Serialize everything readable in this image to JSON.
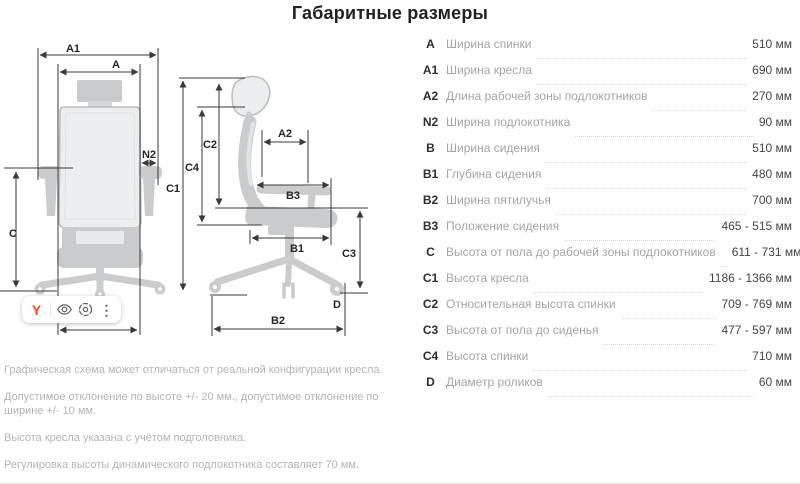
{
  "title": "Габаритные размеры",
  "diagram": {
    "labels": {
      "a": "A",
      "a1": "A1",
      "a2": "A2",
      "n2": "N2",
      "b1": "B1",
      "b2": "B2",
      "b3": "B3",
      "c": "C",
      "c1": "C1",
      "c2": "C2",
      "c3": "C3",
      "c4": "C4",
      "d": "D"
    }
  },
  "toolbar": {
    "yandex_label": "Y",
    "more_label": "⋮",
    "icons": [
      "yandex-logo",
      "eye-icon",
      "search-by-image-icon",
      "more-dots-icon"
    ]
  },
  "table": {
    "rows": [
      {
        "key": "A",
        "label": "Ширина спинки",
        "value": "510 мм"
      },
      {
        "key": "A1",
        "label": "Ширина кресла",
        "value": "690 мм"
      },
      {
        "key": "A2",
        "label": "Длина рабочей зоны подлокотников",
        "value": "270 мм"
      },
      {
        "key": "N2",
        "label": "Ширина подлокотника",
        "value": "90 мм"
      },
      {
        "key": "B",
        "label": "Ширина сидения",
        "value": "510 мм"
      },
      {
        "key": "B1",
        "label": "Глубина сидения",
        "value": "480 мм"
      },
      {
        "key": "B2",
        "label": "Ширина пятилучья",
        "value": "700 мм"
      },
      {
        "key": "B3",
        "label": "Положение сидения",
        "value": "465 - 515 мм"
      },
      {
        "key": "C",
        "label": "Высота от пола до рабочей зоны подлокотников",
        "value": "611 - 731 мм"
      },
      {
        "key": "C1",
        "label": "Высота кресла",
        "value": "1186 - 1366 мм"
      },
      {
        "key": "C2",
        "label": "Относительная высота спинки",
        "value": "709 - 769 мм"
      },
      {
        "key": "C3",
        "label": "Высота от пола до сиденья",
        "value": "477 - 597 мм"
      },
      {
        "key": "C4",
        "label": "Высота спинки",
        "value": "710 мм"
      },
      {
        "key": "D",
        "label": "Диаметр роликов",
        "value": "60 мм"
      }
    ]
  },
  "notes": [
    "Графическая схема может отличаться от реальной конфигурации кресла.",
    "Допустимое отклонение по высоте +/- 20 мм., допустимое отклонение по ширине +/- 10 мм.",
    "Высота кресла указана с учётом подголовника.",
    "Регулировка высоты динамического подлокотника составляет 70 мм."
  ],
  "colors": {
    "accent_red": "#fc3f1d",
    "silhouette": "#c9cbcc",
    "dim_line": "#3a3a3a",
    "muted_text": "#a5a5a5"
  }
}
